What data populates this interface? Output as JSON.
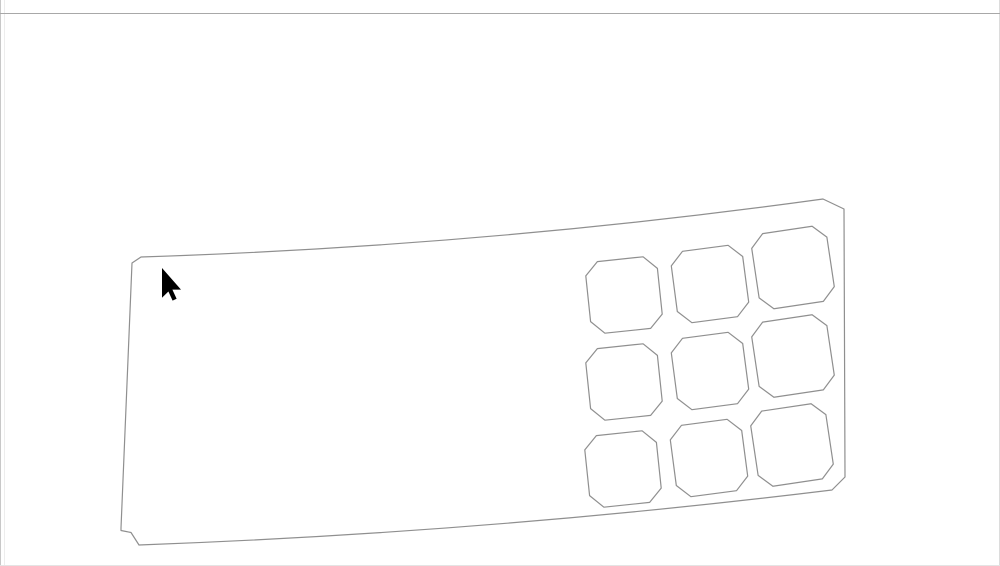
{
  "window": {
    "background": "#ffffff",
    "borders": {
      "left_outer": "#c8c8c8",
      "left_inner": "#ededed",
      "right": "#dcdcdc",
      "bottom": "#e4e4e4",
      "top_divider": "#a8a8a8"
    }
  },
  "drawing": {
    "outline_color": "#8f8f8f",
    "stroke_width": "1.2",
    "plate_path": "M141 257 Q483 246 823 199 L844 209 L845 477 L832 490 Q484.5 532.5 139 545 L131 532.5 L121 530.5 L121 528 L132 263 Z",
    "cell_shape_small": "M-23 -36 L23 -36 L36 -23 L36 23 L23 36 L-23 36 L-36 23 L-36 -23 Z",
    "cell_shape_large": "M-25 -38 L25 -38 L38 -25 L38 25 L25 38 L-25 38 L-38 25 L-38 -25 Z",
    "grid": {
      "rows": 3,
      "cols": 3
    },
    "cells": [
      {
        "x": 624,
        "y": 295,
        "rot": -6,
        "size": "small"
      },
      {
        "x": 710,
        "y": 284,
        "rot": -7.5,
        "size": "small"
      },
      {
        "x": 793,
        "y": 267.5,
        "rot": -8.5,
        "size": "large"
      },
      {
        "x": 624,
        "y": 382,
        "rot": -6,
        "size": "small"
      },
      {
        "x": 710,
        "y": 371,
        "rot": -7.5,
        "size": "small"
      },
      {
        "x": 793,
        "y": 356,
        "rot": -8.5,
        "size": "large"
      },
      {
        "x": 623,
        "y": 469,
        "rot": -6,
        "size": "small"
      },
      {
        "x": 709,
        "y": 458,
        "rot": -7.5,
        "size": "small"
      },
      {
        "x": 792,
        "y": 445,
        "rot": -8.5,
        "size": "large"
      }
    ]
  },
  "cursor": {
    "color": "#000000",
    "path": "M162 268 L162 297.8 L168.4 291.5 L172.6 300.6 L176.6 298.7 L172.4 289.6 L181 289.6 Z"
  }
}
